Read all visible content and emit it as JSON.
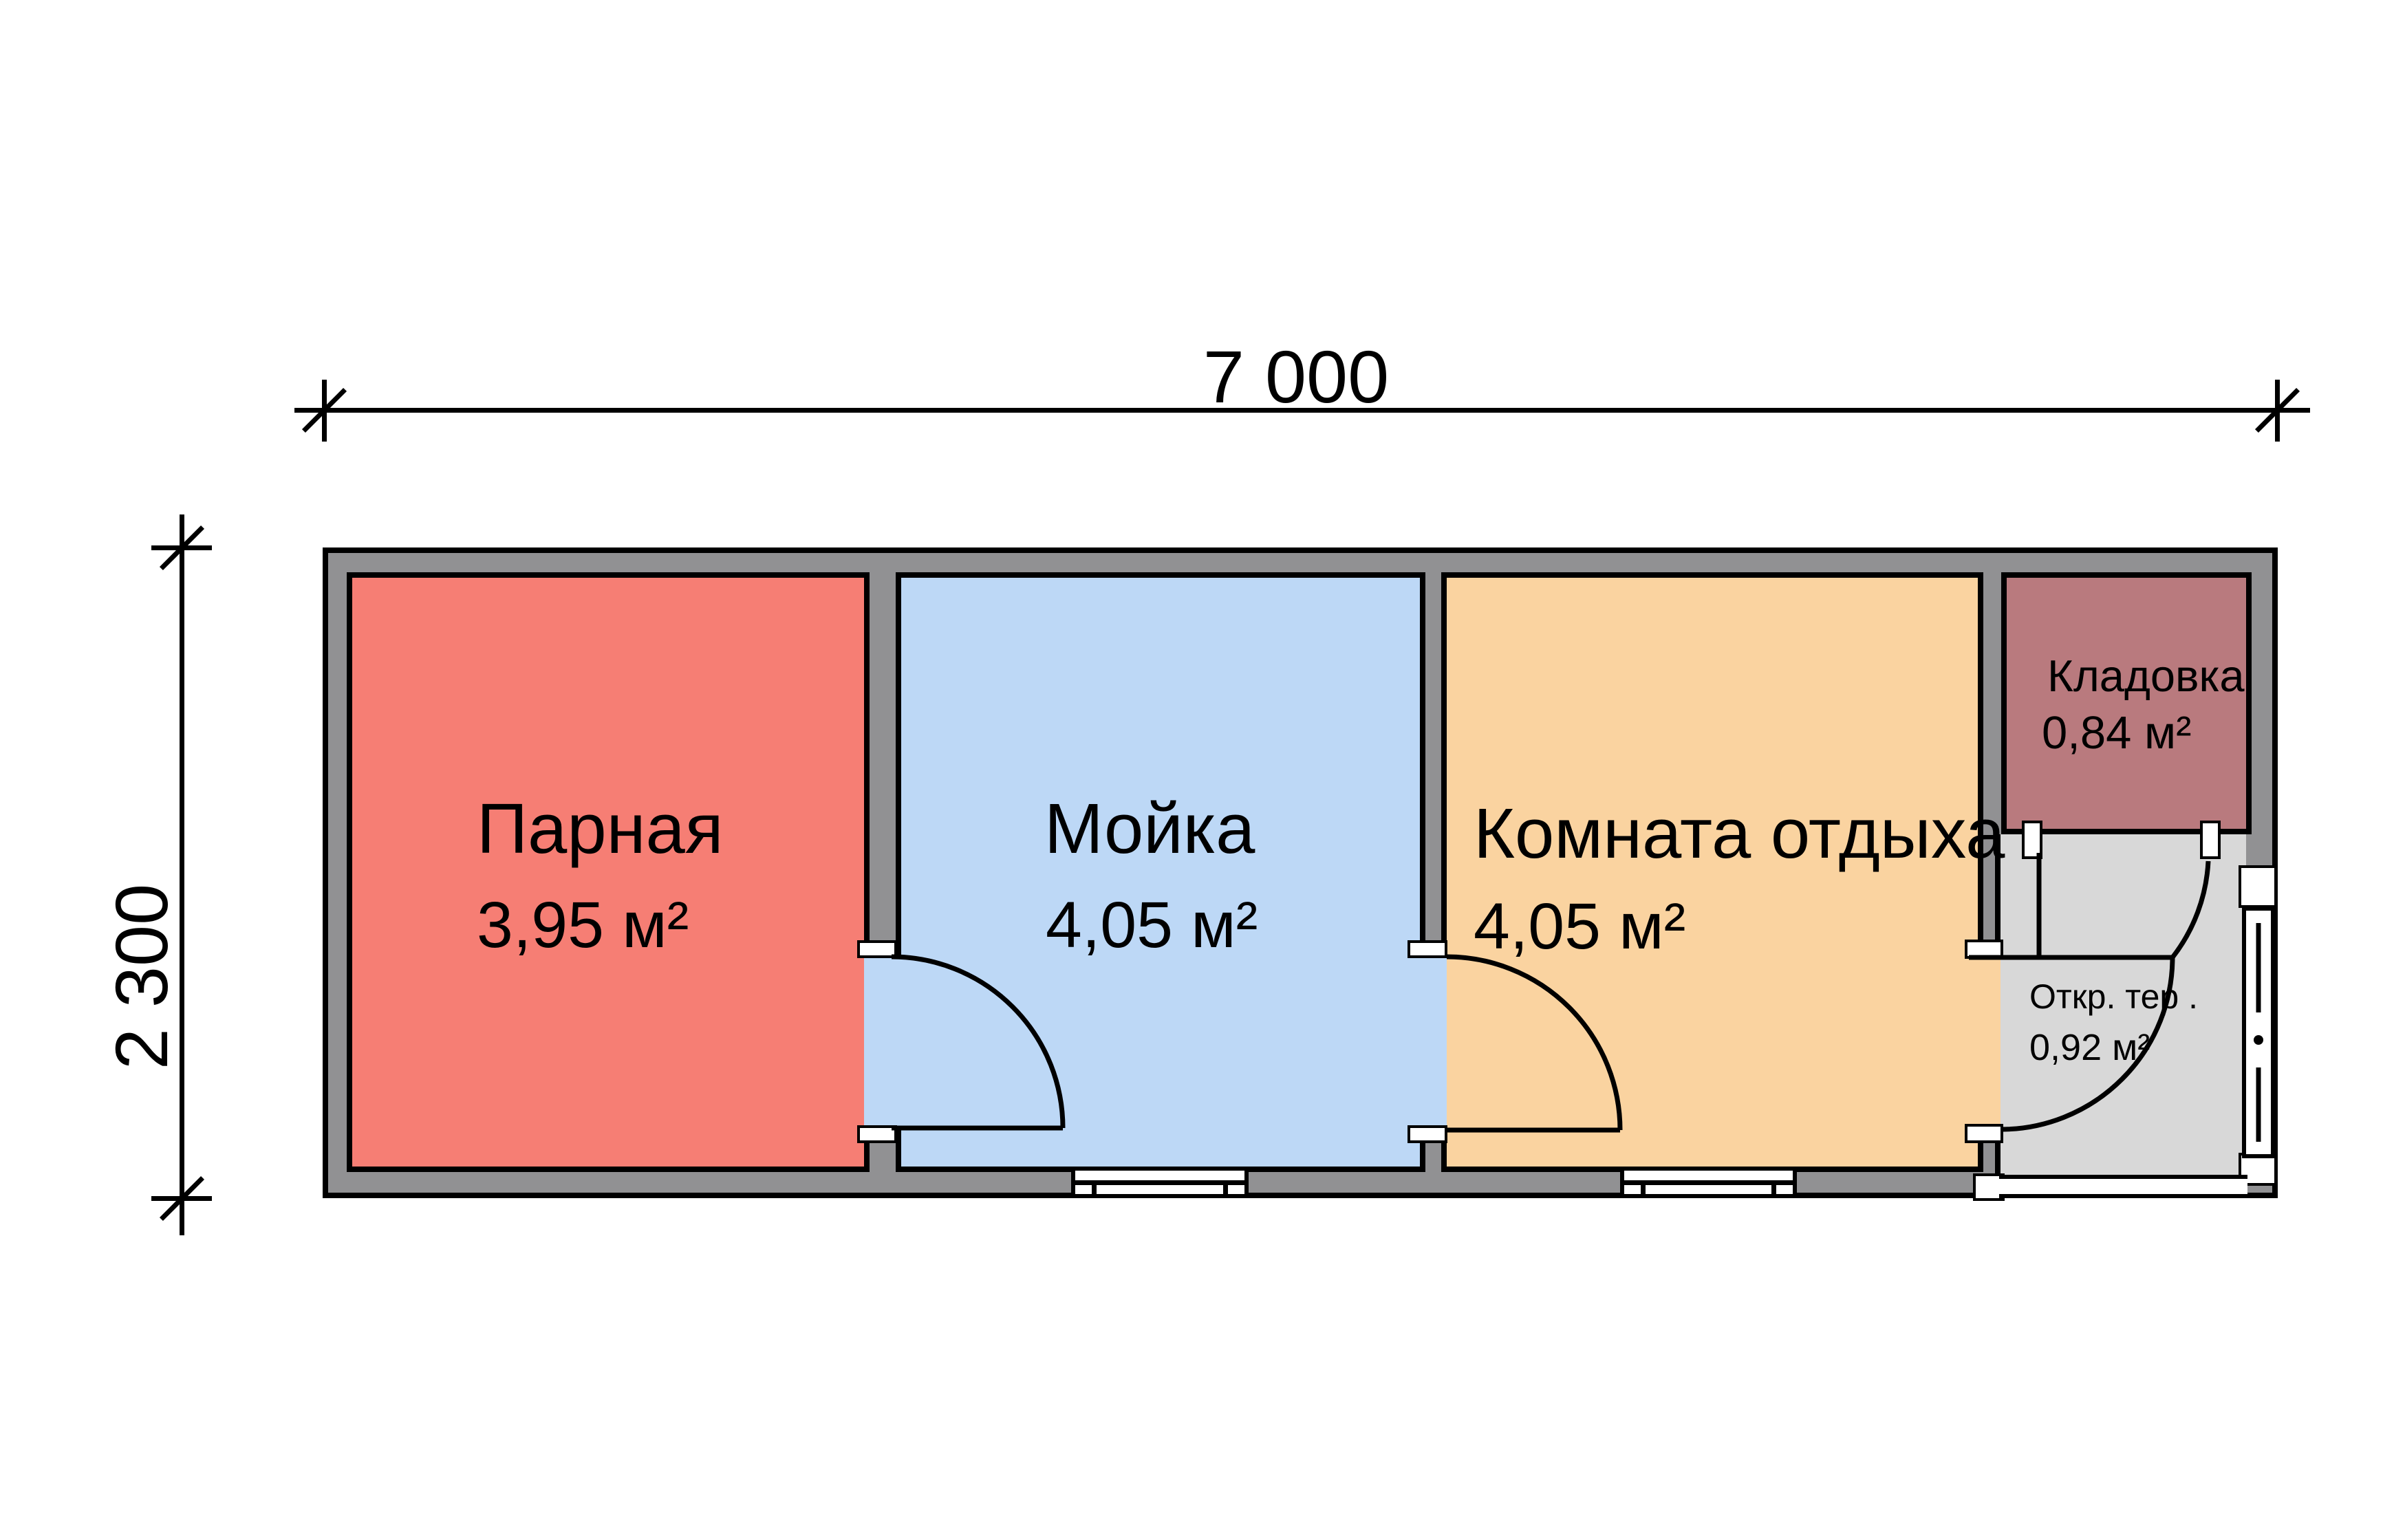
{
  "dimensions": {
    "width_label": "7 000",
    "height_label": "2 300"
  },
  "rooms": [
    {
      "name": "Парная",
      "area": "3,95 м²",
      "color": "#F67E74"
    },
    {
      "name": "Мойка",
      "area": "4,05 м²",
      "color": "#BDD8F6"
    },
    {
      "name": "Комната отдыха",
      "area": "4,05 м²",
      "color": "#FAD3A0"
    },
    {
      "name": "Кладовка",
      "area": "0,84 м²",
      "color": "#B97A7E"
    },
    {
      "name": "Откр. тер .",
      "area": "0,92 м²",
      "color": "#D8D8D8"
    }
  ],
  "colors": {
    "wall": "#919193",
    "outline": "#000000",
    "background": "#FFFFFF",
    "jamb": "#FFFFFF"
  }
}
